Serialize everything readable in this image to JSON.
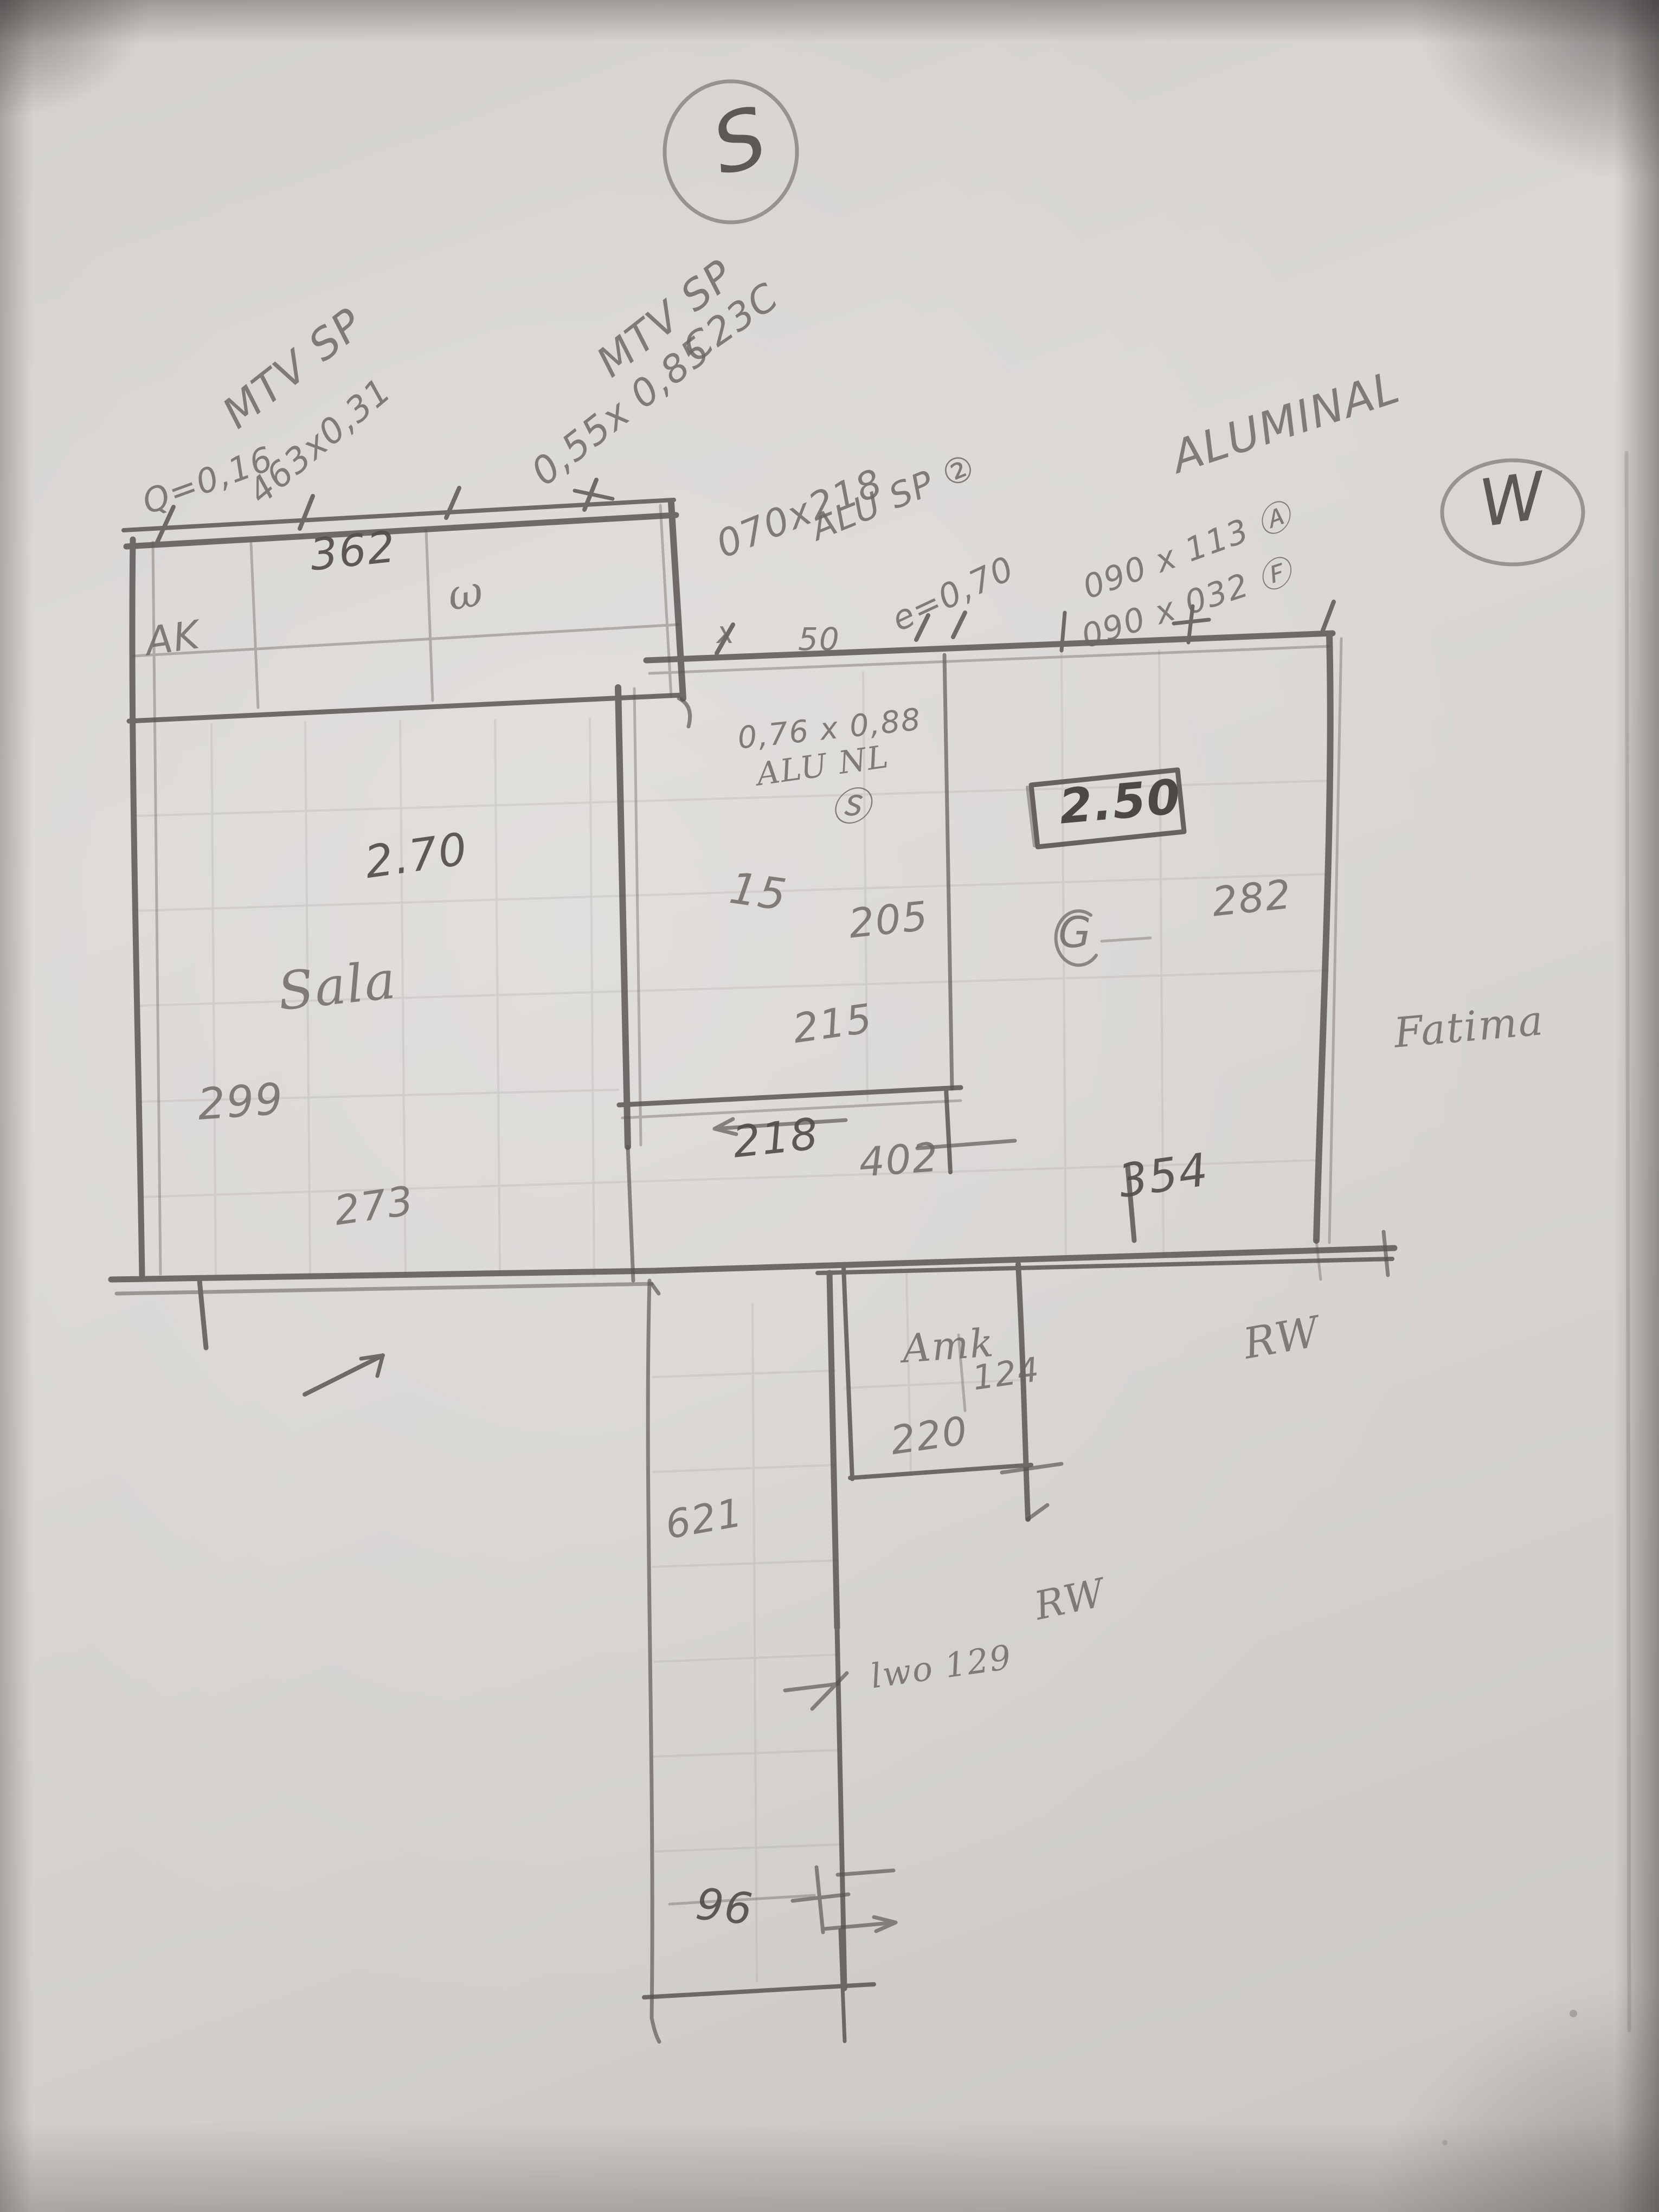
{
  "scene": {
    "medium": "hand-drawn pencil floor plan sketch on paper",
    "paper_color": "#d6d3d0",
    "pencil_color": "#6b6762"
  },
  "compass": {
    "south_label": "S",
    "west_label": "W"
  },
  "labels": {
    "mtv_sp_left": "MTV SP",
    "q_value": "Q=0,16",
    "dim_463x031": "463x0,31",
    "mtv_sp_mid": "MTV SP",
    "dim_055x085": "0,55x 0,85",
    "code_c23c": "C23C",
    "dim_070x218": "070x218",
    "alu_sp_2": "ALU SP ②",
    "e_value": "e=0,70",
    "material_alu": "ALUMINAL",
    "dim_090x113_a": "090 x 113 Ⓐ",
    "dim_090x032_f": "090 x 032 Ⓕ",
    "mark_x": "x",
    "mark_50": "50",
    "dim_076x088": "0,76 x 0,88",
    "material_alu_nl": "ALU NL",
    "circle_s": "Ⓢ",
    "dim_362": "362",
    "label_ak": "AK",
    "squiggle_w": "ω",
    "dim_2_70": "2.70",
    "room_sala": "Sala",
    "dim_299": "299",
    "dim_273": "273",
    "dim_15": "15",
    "dim_205": "205",
    "dim_215": "215",
    "dim_218": "218",
    "boxed_2_50": "2.50",
    "label_g": "G",
    "dim_282": "282",
    "dim_402": "402",
    "dim_354": "354",
    "name_fatima": "Fatima",
    "room_amk": "Amk",
    "dim_124": "124",
    "dim_220": "220",
    "label_rw_upper": "RW",
    "dim_621": "621",
    "label_rw_lower": "RW",
    "note_129": "lwo 129",
    "dim_96": "96"
  }
}
